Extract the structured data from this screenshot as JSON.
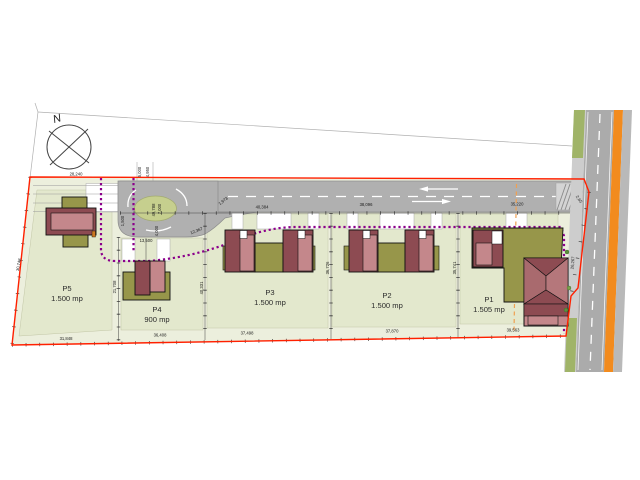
{
  "plan": {
    "title": "residential-subdivision-site-plan",
    "north_label": "N",
    "parcels": [
      {
        "id": "P5",
        "area": "1.500 mp"
      },
      {
        "id": "P4",
        "area": "900 mp"
      },
      {
        "id": "P3",
        "area": "1.500 mp"
      },
      {
        "id": "P2",
        "area": "1.500 mp"
      },
      {
        "id": "P1",
        "area": "1.505 mp"
      }
    ],
    "dimensions": {
      "top_left": "28,240",
      "top_p3": "40,384",
      "top_p2": "38,096",
      "top_p1": "35,220",
      "bottom_p5": "31,848",
      "bottom_p4": "36,408",
      "bottom_p3": "37,498",
      "bottom_p2": "37,870",
      "bottom_p1": "39,563",
      "left_edge": "30,748",
      "div_p5_p4": "21,708",
      "div_p4_p3": "40,331",
      "div_p3_p2": "36,726",
      "div_p2_p1": "35,741",
      "right_edge": "26,267",
      "right_corner": "2,65",
      "bulb_width": "13,500",
      "bulb_offset": "1,500",
      "bulb_radius": "4,000",
      "island_a": "7,000",
      "island_b": "49,788",
      "road_taper": "1,973",
      "road_curve": "12,367",
      "stub_a": "5,000",
      "stub_b": "4,950"
    },
    "colors": {
      "boundary_red": "#ff2000",
      "utility_purple": "#8b008b",
      "road_gray": "#b0b0b0",
      "orange_lane": "#f28b1e",
      "orange_axis": "#f0a050",
      "roof_dark": "#8d4b52",
      "roof_light": "#c4878b",
      "terrace_olive": "#97964a",
      "island_green": "#c6cf8e",
      "site_fill": "#ecefdd",
      "parcel_fill": "#e3e8cd"
    }
  }
}
